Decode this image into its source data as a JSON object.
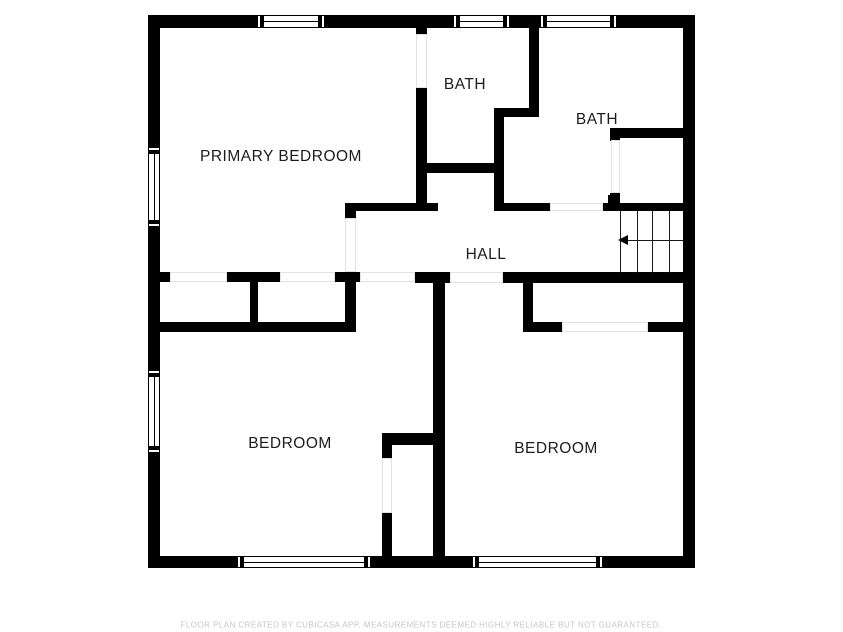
{
  "floor_plan": {
    "rooms": [
      {
        "name": "primary-bedroom",
        "label": "PRIMARY BEDROOM"
      },
      {
        "name": "bath-1",
        "label": "BATH"
      },
      {
        "name": "bath-2",
        "label": "BATH"
      },
      {
        "name": "hall",
        "label": "HALL"
      },
      {
        "name": "bedroom-left",
        "label": "BEDROOM"
      },
      {
        "name": "bedroom-right",
        "label": "BEDROOM"
      }
    ],
    "stairs": {
      "icon": "left-arrow",
      "steps_visible": 4
    },
    "windows": {
      "top_wall": 3,
      "bottom_wall": 2,
      "left_wall": 2
    },
    "footer_disclaimer": "FLOOR PLAN CREATED BY CUBICASA APP. MEASUREMENTS DEEMED HIGHLY RELIABLE BUT NOT GUARANTEED.",
    "colors": {
      "wall": "#000000",
      "label_text": "#1c1c1c",
      "footer_text": "#c6c6c6",
      "background": "#ffffff",
      "opening_outline": "#e2e2e2"
    }
  }
}
